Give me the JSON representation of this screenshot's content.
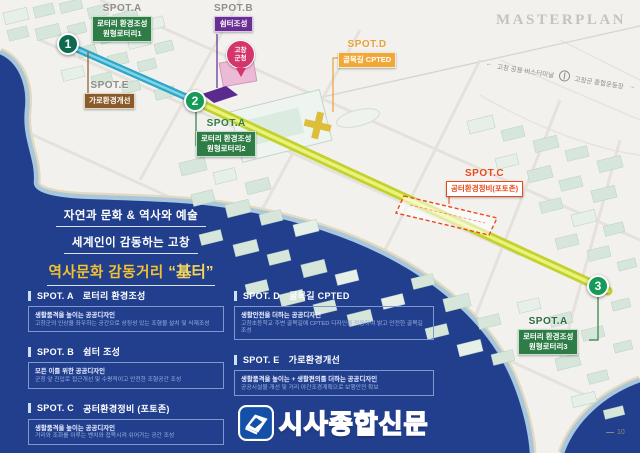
{
  "header": {
    "masterplan": "MASTERPLAN",
    "direction": {
      "left_arrow": "←",
      "left_text": "고창 공용 버스터미널",
      "right_text": "고창군 종합운동장",
      "right_arrow": "→"
    }
  },
  "map": {
    "markers": [
      {
        "number": "1"
      },
      {
        "number": "2"
      },
      {
        "number": "3"
      }
    ],
    "spots": [
      {
        "label": "SPOT.A",
        "line1": "로터리 환경조성",
        "line2": "원형로터리1"
      },
      {
        "label": "SPOT.B",
        "line1": "쉼터조성"
      },
      {
        "label": "SPOT.E",
        "line1": "가로환경개선"
      },
      {
        "label": "SPOT.D",
        "line1": "골목길 CPTED"
      },
      {
        "label": "SPOT.A",
        "line1": "로터리 환경조성",
        "line2": "원형로터리2"
      },
      {
        "label": "SPOT.C",
        "line1": "공터환경정비(포토존)"
      },
      {
        "label": "SPOT.A",
        "line1": "로터리 환경조성",
        "line2": "원형로터리3"
      }
    ],
    "pin": {
      "line1": "고창",
      "line2": "군청"
    }
  },
  "slogan": {
    "line1": "자연과 문화 & 역사와 예술",
    "line2": "세계인이 감동하는 고창",
    "line3_prefix": "역사문화 감동거리",
    "line3_quote": "“基터”"
  },
  "legend": {
    "items": [
      {
        "code": "SPOT. A",
        "title": "로터리 환경조성",
        "box_title": "생활품격을 높이는 공공디자인",
        "detail": "고창군의 인상을 좌우하는 공간으로 상징성 있는 조형물 설치 및 식재조성"
      },
      {
        "code": "SPOT. B",
        "title": "쉼터 조성",
        "box_title": "모든 이를 위한 공공디자인",
        "detail": "군청 앞 진입로 접근개선 및 수평적이고 안전한 조형공간 조성"
      },
      {
        "code": "SPOT. C",
        "title": "공터환경정비 (포토존)",
        "box_title": "생활품격을 높이는 공공디자인",
        "detail": "거리와 조화를 이루는 벤치와 접목시켜 쉬어가는 공간 조성"
      },
      {
        "code": "SPOT. D",
        "title": "골목길 CPTED",
        "box_title": "생활안전을 더하는 공공디자인",
        "detail": "고창초등학교 주변 골목길에 CPTED 디자인을 적용하여 밝고 안전한 골목길 조성"
      },
      {
        "code": "SPOT. E",
        "title": "가로환경개선",
        "box_title": "생활품격을 높이는 + 생활편의를 더하는 공공디자인",
        "detail": "공공시설물 개선 및 거리 야간조경계획으로 보행안전 확보"
      }
    ]
  },
  "footer": {
    "brand": "시사종합신문",
    "page": "10"
  },
  "colors": {
    "water": "#223f8e",
    "road_main": "#c3d12f",
    "road_sub": "#2fa6c6",
    "spot_green": "#2e7d46",
    "spot_purple": "#6a2f93",
    "spot_brown": "#8a5a28",
    "spot_orange": "#f0a838",
    "spot_red": "#e8491d",
    "brand_blue": "#1550a8",
    "slogan_yellow": "#f2c230"
  }
}
